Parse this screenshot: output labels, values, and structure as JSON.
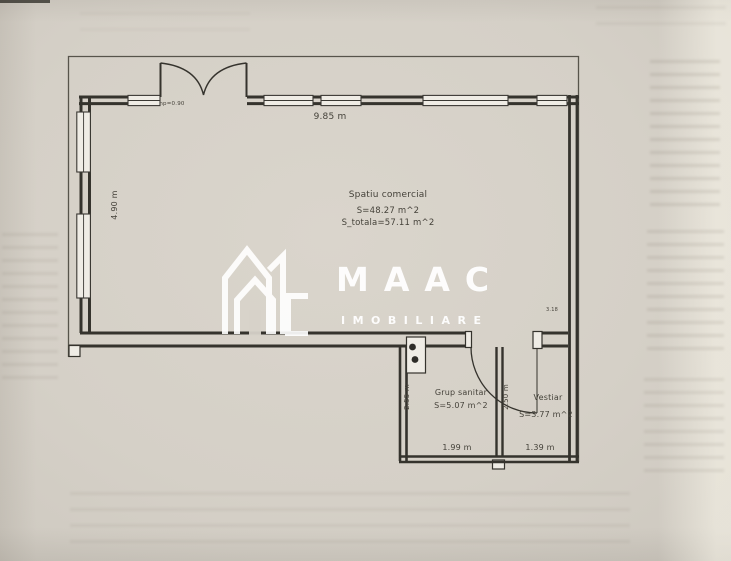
{
  "watermark": {
    "brand": "MAAC",
    "subtitle": "IMOBILIARE",
    "logo": "house-monogram"
  },
  "plan": {
    "main_room": {
      "name": "Spatiu comercial",
      "area": "S=48.27 m^2",
      "area_total": "S_totala=57.11 m^2",
      "width_dim": "9.85 m",
      "depth_dim": "4.90 m",
      "window_note": "hp=0.90",
      "wall_note": "3.18"
    },
    "grup_sanitar": {
      "name": "Grup sanitar",
      "area": "S=5.07 m^2",
      "depth_dim": "2.55 m",
      "width_dim": "1.99 m"
    },
    "vestiar": {
      "name": "Vestiar",
      "area": "S=3.77 m^2",
      "depth_dim": "2.50 m",
      "width_dim": "1.39 m"
    }
  },
  "colors": {
    "paper": "#d6d1c8",
    "line": "#35332d",
    "watermark": "#ffffff"
  }
}
